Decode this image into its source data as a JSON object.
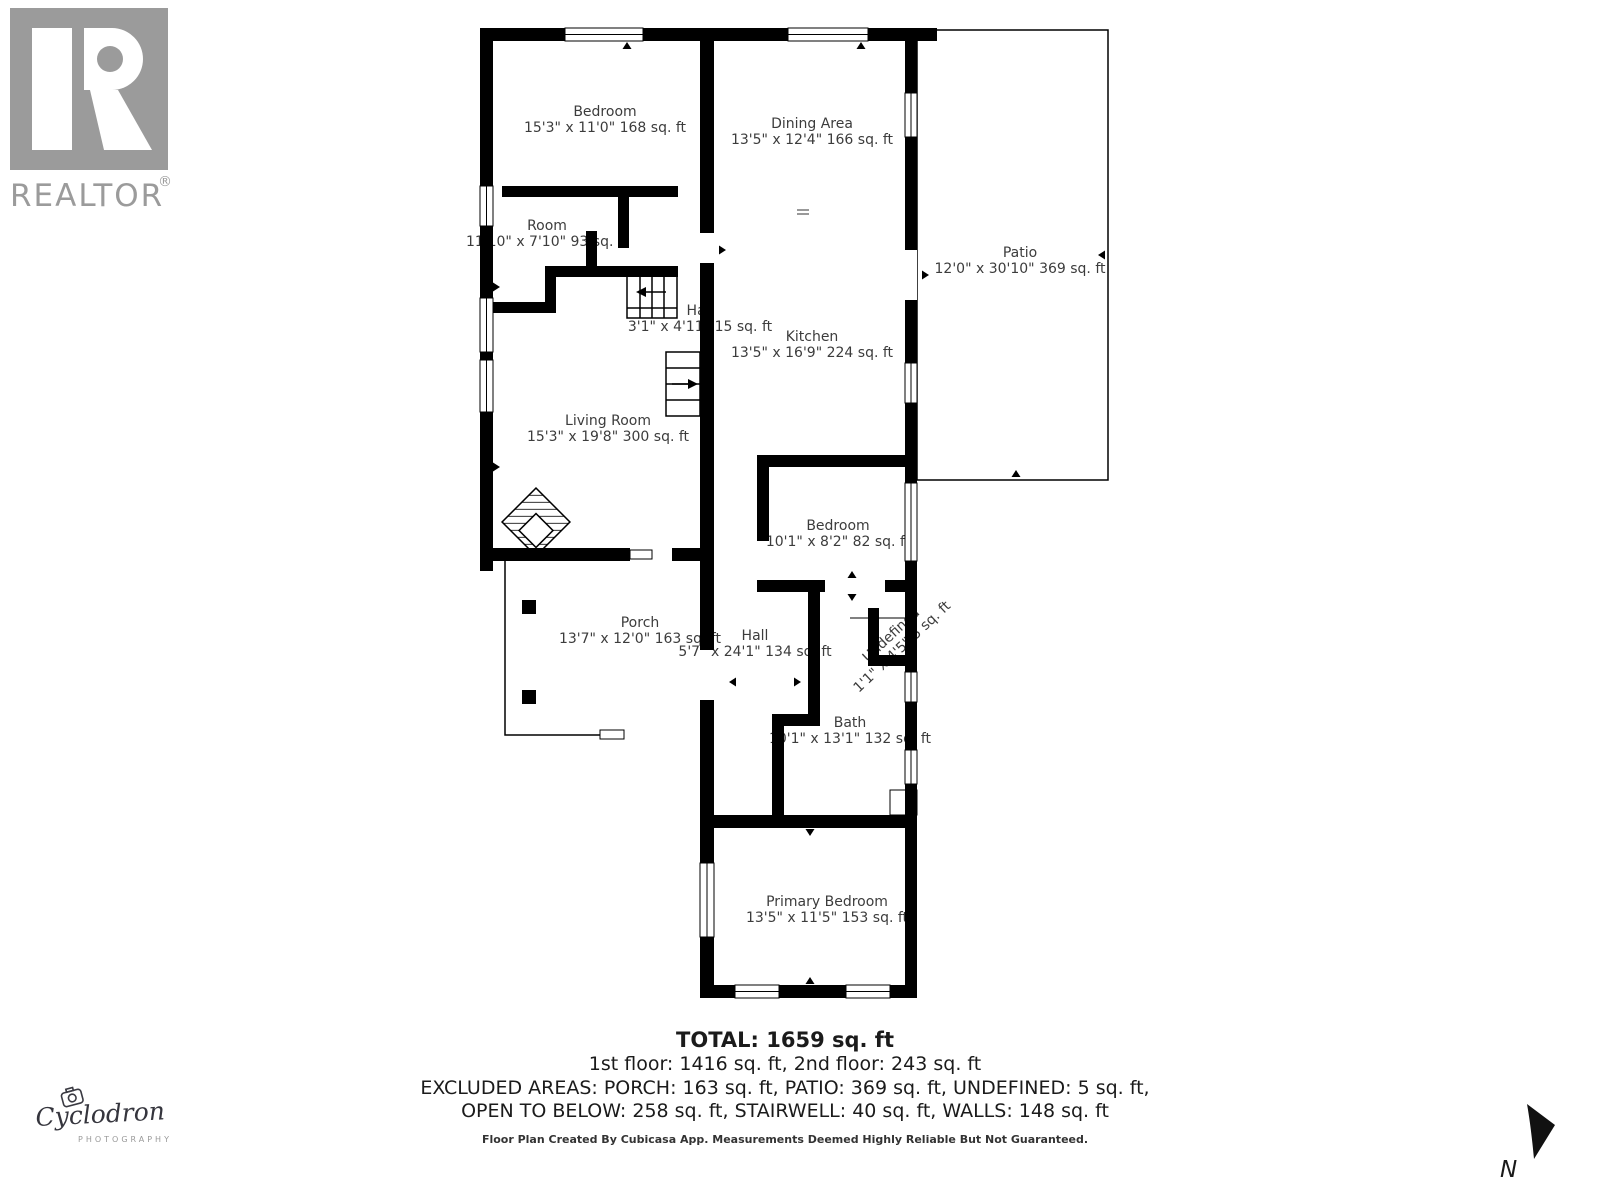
{
  "branding": {
    "realtor_logo_text": "REALTOR",
    "realtor_reg_mark": "®",
    "photographer_name": "Cyclodron",
    "photographer_sub": "PHOTOGRAPHY"
  },
  "compass": {
    "label": "N"
  },
  "colors": {
    "wall": "#000000",
    "room_label": "#3c3c3c",
    "realtor_gray": "#9b9b9b",
    "script_logo": "#35353d"
  },
  "rooms": {
    "bedroom_2f": {
      "name": "Bedroom",
      "dims": "15'3\" x 11'0\" 168 sq. ft"
    },
    "dining": {
      "name": "Dining Area",
      "dims": "13'5\" x 12'4\" 166 sq. ft"
    },
    "room_2f": {
      "name": "Room",
      "dims": "11'10\" x 7'10\" 93 sq. ft"
    },
    "hall_2f": {
      "name": "Hall",
      "dims": "3'1\" x 4'11\" 15 sq. ft"
    },
    "kitchen": {
      "name": "Kitchen",
      "dims": "13'5\" x 16'9\" 224 sq. ft"
    },
    "patio": {
      "name": "Patio",
      "dims": "12'0\" x 30'10\" 369 sq. ft"
    },
    "living_room": {
      "name": "Living Room",
      "dims": "15'3\" x 19'8\" 300 sq. ft"
    },
    "bedroom_1f": {
      "name": "Bedroom",
      "dims": "10'1\" x 8'2\" 82 sq. ft"
    },
    "porch": {
      "name": "Porch",
      "dims": "13'7\" x 12'0\" 163 sq. ft"
    },
    "hall_1f": {
      "name": "Hall",
      "dims": "5'7\" x 24'1\" 134 sq. ft"
    },
    "undefined_area": {
      "name": "Undefined",
      "dims": "1'1\" x 4'5\" 5 sq. ft"
    },
    "bath": {
      "name": "Bath",
      "dims": "10'1\" x 13'1\" 132 sq. ft"
    },
    "primary_bedroom": {
      "name": "Primary Bedroom",
      "dims": "13'5\" x 11'5\" 153 sq. ft"
    }
  },
  "summary": {
    "total": "TOTAL: 1659 sq. ft",
    "floors": "1st floor: 1416 sq. ft, 2nd floor: 243 sq. ft",
    "excluded_1": "EXCLUDED AREAS: PORCH: 163 sq. ft, PATIO: 369 sq. ft, UNDEFINED: 5 sq. ft,",
    "excluded_2": "OPEN TO BELOW: 258 sq. ft, STAIRWELL: 40 sq. ft, WALLS: 148 sq. ft",
    "disclaimer": "Floor Plan Created By Cubicasa App. Measurements Deemed Highly Reliable But Not Guaranteed."
  }
}
